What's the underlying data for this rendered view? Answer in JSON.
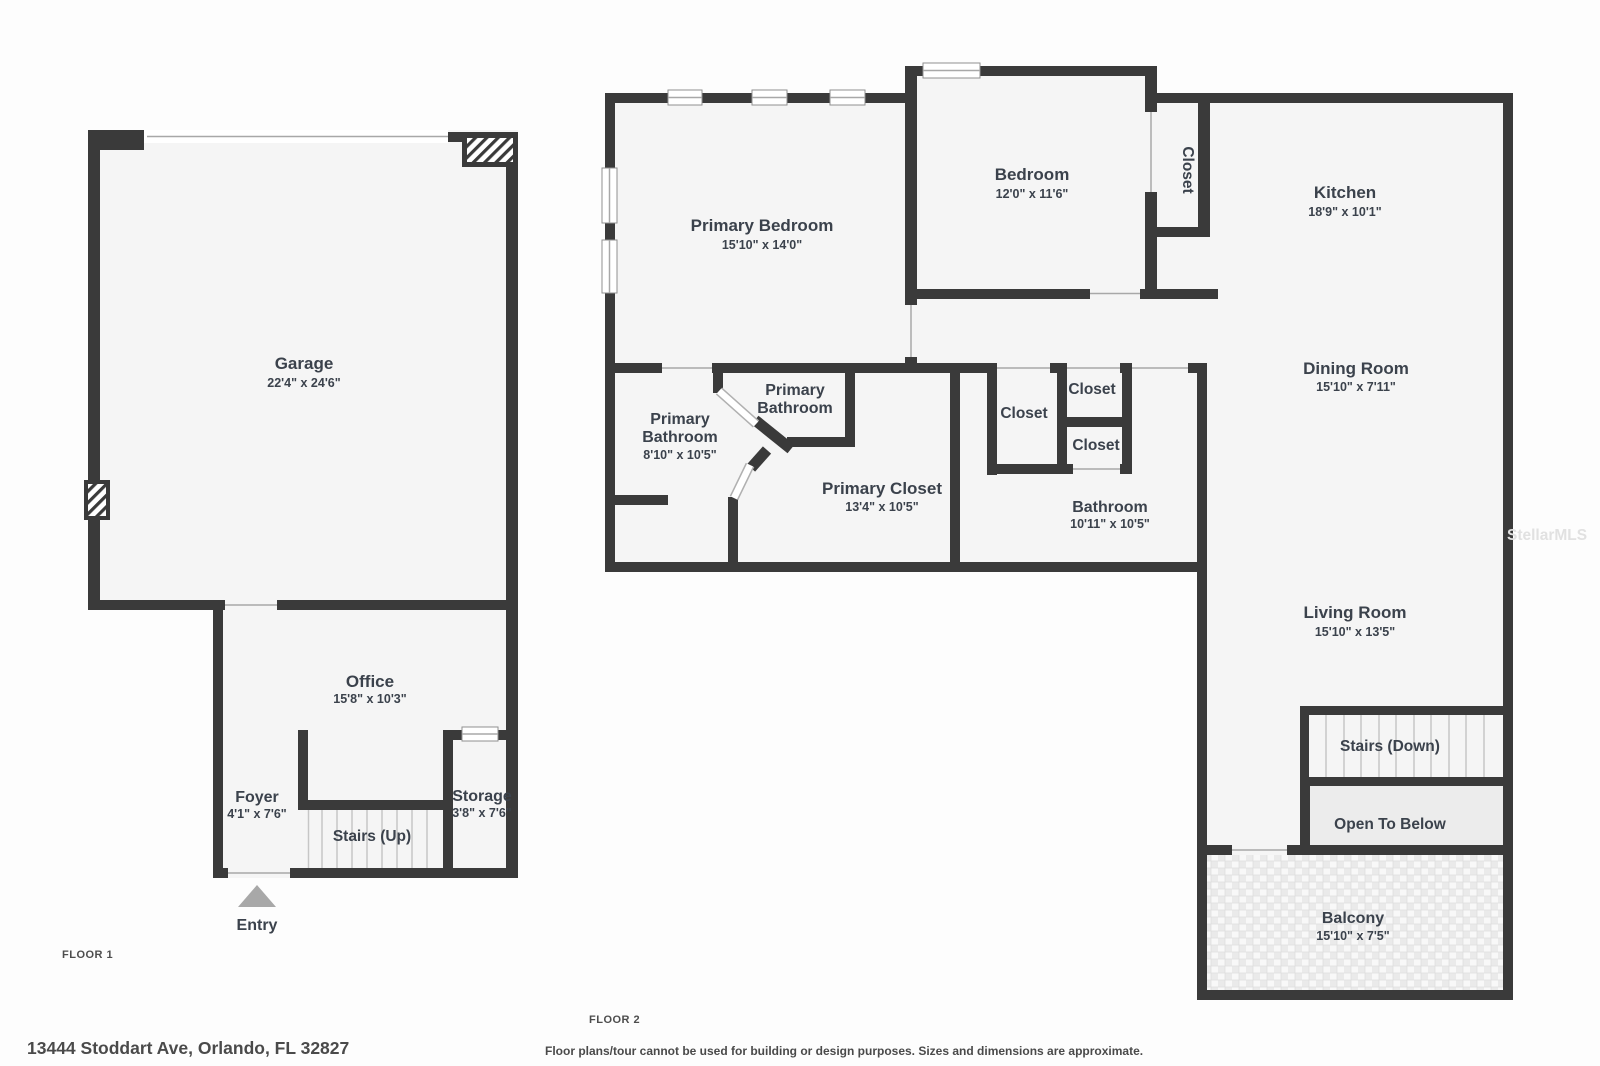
{
  "floor1": {
    "label": "FLOOR 1",
    "rooms": {
      "garage": {
        "name": "Garage",
        "dims": "22'4\" x 24'6\""
      },
      "office": {
        "name": "Office",
        "dims": "15'8\" x 10'3\""
      },
      "foyer": {
        "name": "Foyer",
        "dims": "4'1\" x 7'6\""
      },
      "stairs_up": {
        "name": "Stairs (Up)"
      },
      "storage": {
        "name": "Storage",
        "dims": "3'8\" x 7'6\""
      },
      "entry": {
        "name": "Entry"
      }
    }
  },
  "floor2": {
    "label": "FLOOR 2",
    "rooms": {
      "primary_bedroom": {
        "name": "Primary Bedroom",
        "dims": "15'10\" x 14'0\""
      },
      "bedroom": {
        "name": "Bedroom",
        "dims": "12'0\" x 11'6\""
      },
      "bedroom_closet": {
        "name": "Closet"
      },
      "kitchen": {
        "name": "Kitchen",
        "dims": "18'9\" x 10'1\""
      },
      "dining_room": {
        "name": "Dining Room",
        "dims": "15'10\" x 7'11\""
      },
      "primary_bathroom_main": {
        "line1": "Primary",
        "line2": "Bathroom",
        "dims": "8'10\" x 10'5\""
      },
      "primary_bathroom_small": {
        "line1": "Primary",
        "line2": "Bathroom"
      },
      "primary_closet": {
        "name": "Primary Closet",
        "dims": "13'4\" x 10'5\""
      },
      "closet_hall": {
        "name": "Closet"
      },
      "closet_upper": {
        "name": "Closet"
      },
      "closet_lower": {
        "name": "Closet"
      },
      "bathroom": {
        "name": "Bathroom",
        "dims": "10'11\" x 10'5\""
      },
      "living_room": {
        "name": "Living Room",
        "dims": "15'10\" x 13'5\""
      },
      "stairs_down": {
        "name": "Stairs (Down)"
      },
      "open_to_below": {
        "name": "Open To Below"
      },
      "balcony": {
        "name": "Balcony",
        "dims": "15'10\" x 7'5\""
      }
    }
  },
  "footer": {
    "address": "13444 Stoddart Ave, Orlando, FL 32827",
    "disclaimer": "Floor plans/tour cannot be used for building or design purposes. Sizes and dimensions are approximate."
  },
  "watermark": "StellarMLS",
  "colors": {
    "wall": "#3a3a3a",
    "room_fill": "#f5f5f5",
    "open_to_below_fill": "#ececec",
    "label_text": "#3b424c",
    "entry_arrow": "#a8a8a8"
  }
}
